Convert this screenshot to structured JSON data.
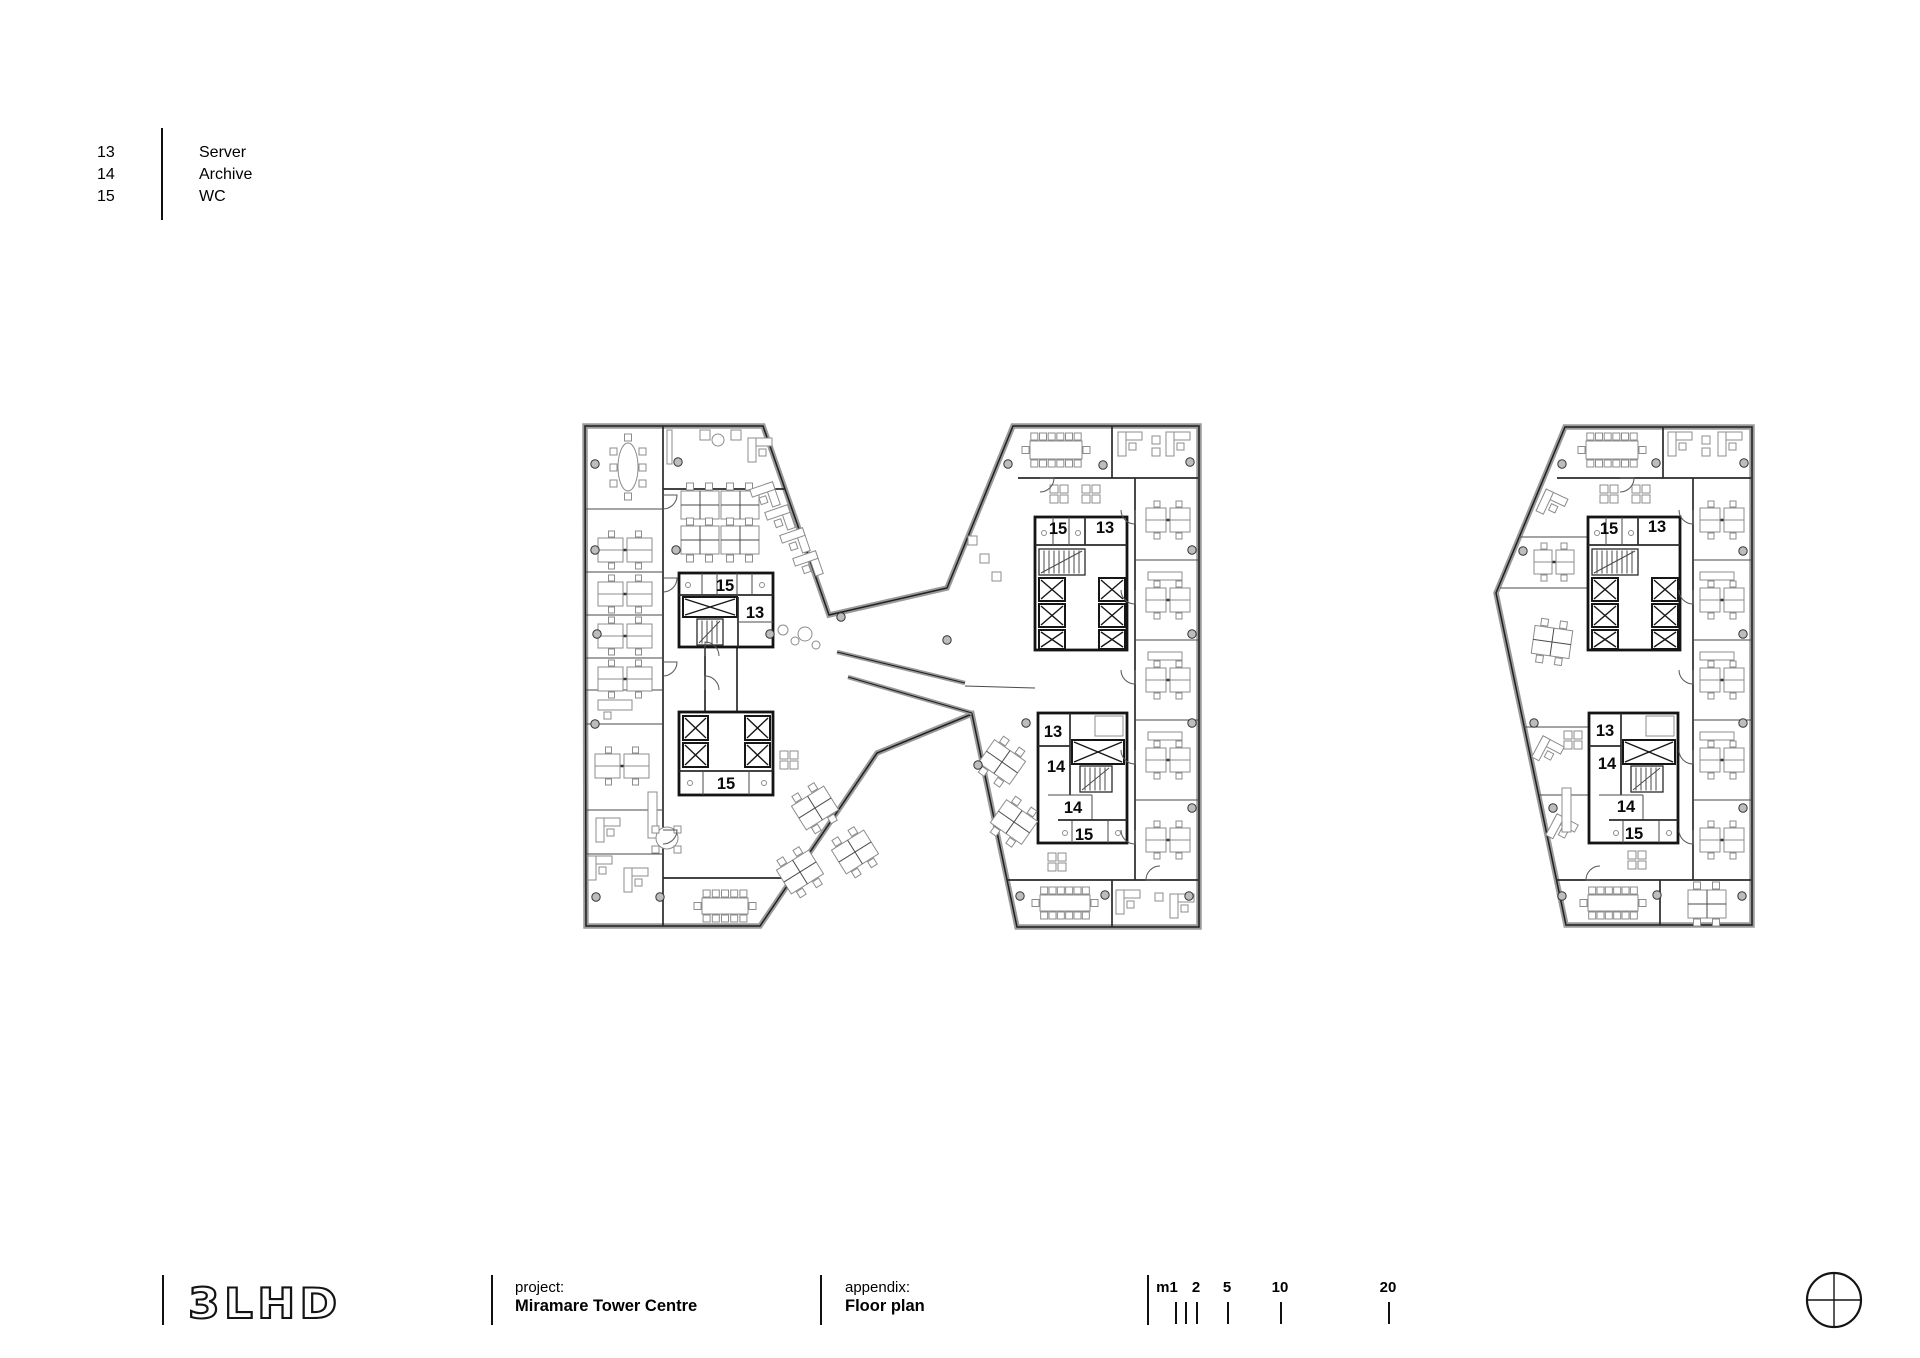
{
  "legend": {
    "rows": [
      {
        "num": "13",
        "label": "Server"
      },
      {
        "num": "14",
        "label": "Archive"
      },
      {
        "num": "15",
        "label": "WC"
      }
    ]
  },
  "title_block": {
    "logo_text": "3LHD",
    "project_label": "project:",
    "project_value": "Miramare Tower Centre",
    "appendix_label": "appendix:",
    "appendix_value": "Floor plan",
    "scale_bar": {
      "labels": [
        {
          "text": "m1",
          "x": 1167
        },
        {
          "text": "2",
          "x": 1196
        },
        {
          "text": "5",
          "x": 1227
        },
        {
          "text": "10",
          "x": 1280
        },
        {
          "text": "20",
          "x": 1388
        }
      ],
      "ticks_x": [
        1175,
        1185,
        1196,
        1227,
        1280,
        1388
      ]
    }
  },
  "colors": {
    "ink": "#141414",
    "wall_gray": "#9a9a9a",
    "paper": "#ffffff"
  },
  "plans": {
    "left": {
      "name": "twin-tower-floor-plan",
      "room_labels": [
        {
          "text": "15",
          "x": 725,
          "y": 585
        },
        {
          "text": "13",
          "x": 755,
          "y": 612
        },
        {
          "text": "15",
          "x": 726,
          "y": 783
        },
        {
          "text": "15",
          "x": 1058,
          "y": 528
        },
        {
          "text": "13",
          "x": 1105,
          "y": 527
        },
        {
          "text": "13",
          "x": 1053,
          "y": 731
        },
        {
          "text": "14",
          "x": 1056,
          "y": 766
        },
        {
          "text": "14",
          "x": 1073,
          "y": 807
        },
        {
          "text": "15",
          "x": 1084,
          "y": 834
        }
      ]
    },
    "right": {
      "name": "single-tower-floor-plan",
      "room_labels": [
        {
          "text": "15",
          "x": 1609,
          "y": 528
        },
        {
          "text": "13",
          "x": 1657,
          "y": 526
        },
        {
          "text": "13",
          "x": 1605,
          "y": 730
        },
        {
          "text": "14",
          "x": 1607,
          "y": 763
        },
        {
          "text": "14",
          "x": 1626,
          "y": 806
        },
        {
          "text": "15",
          "x": 1634,
          "y": 833
        }
      ]
    }
  }
}
